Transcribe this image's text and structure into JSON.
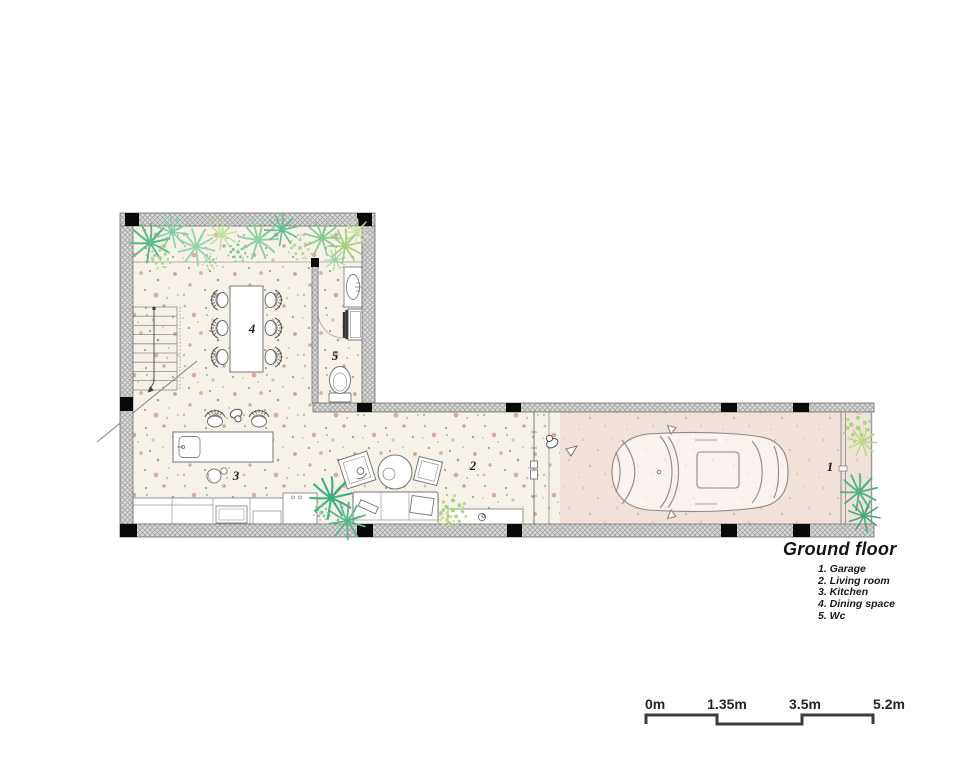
{
  "legend": {
    "title": "Ground floor",
    "items": [
      "1. Garage",
      "2. Living room",
      "3. Kitchen",
      "4. Dining space",
      "5. Wc"
    ]
  },
  "room_labels": {
    "garage": "1",
    "living_room": "2",
    "kitchen": "3",
    "dining_space": "4",
    "wc": "5"
  },
  "scale_bar": {
    "ticks": [
      "0m",
      "1.35m",
      "3.5m",
      "5.2m"
    ]
  },
  "icons": {
    "car": "car-top-view-icon",
    "plants": "plant-icon",
    "stairs": "stairs-icon",
    "toilet": "toilet-icon",
    "sink": "sink-icon"
  },
  "colors": {
    "floor_terrazzo": "#f6f2ea",
    "floor_garage": "#f1e2d9",
    "wall_fill": "#d9d9d9",
    "wall_hatch": "#a3a3a3",
    "column": "#0a0a0a",
    "plant_green": "#57b98b",
    "plant_light_green": "#b5dc7f",
    "outline": "#777777",
    "scale_bar_line": "#3d3d3d"
  }
}
